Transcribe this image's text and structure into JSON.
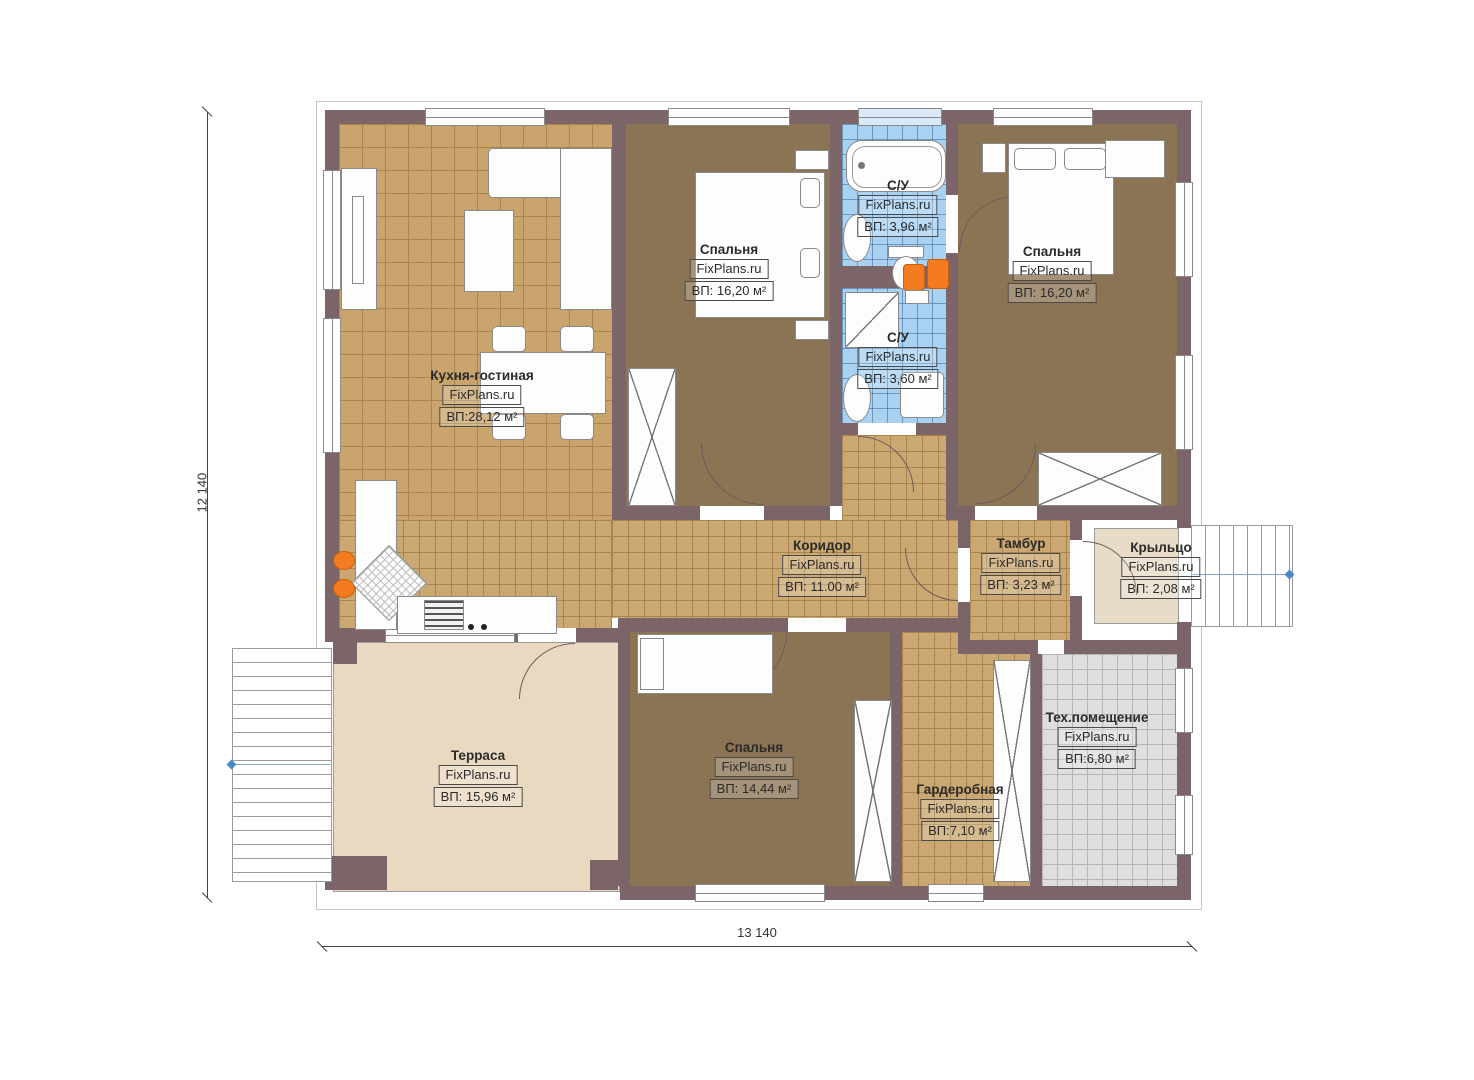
{
  "watermark": {
    "text": "FixPlans.ru"
  },
  "dimensions": {
    "height_label": "12 140",
    "width_label": "13 140"
  },
  "rooms": [
    {
      "key": "kitchen-living",
      "name": "Кухня-гостиная",
      "area": "ВП:28,12 м²"
    },
    {
      "key": "bedroom-top",
      "name": "Спальня",
      "area": "ВП: 16,20 м²"
    },
    {
      "key": "bathroom-top",
      "name": "С/У",
      "area": "ВП: 3,96 м²"
    },
    {
      "key": "bedroom-right",
      "name": "Спальня",
      "area": "ВП: 16,20 м²"
    },
    {
      "key": "bathroom-bottom",
      "name": "С/У",
      "area": "ВП: 3,60 м²"
    },
    {
      "key": "corridor",
      "name": "Коридор",
      "area": "ВП: 11.00 м²"
    },
    {
      "key": "vestibule",
      "name": "Тамбур",
      "area": "ВП: 3,23 м²"
    },
    {
      "key": "porch",
      "name": "Крыльцо",
      "area": "ВП: 2,08 м²"
    },
    {
      "key": "terrace",
      "name": "Терраса",
      "area": "ВП: 15,96 м²"
    },
    {
      "key": "bedroom-bottom",
      "name": "Спальня",
      "area": "ВП: 14,44 м²"
    },
    {
      "key": "wardrobe",
      "name": "Гардеробная",
      "area": "ВП:7,10 м²"
    },
    {
      "key": "tech-room",
      "name": "Тех.помещение",
      "area": "ВП:6,80 м²"
    }
  ],
  "colors": {
    "wall": "#7c6568",
    "bedroom_floor": "#8b7454",
    "tile_floor": "#c9a46c",
    "bath_floor": "#a9d2f2",
    "terrace_floor": "#ead9c1",
    "tech_floor": "#dedede",
    "accent_orange": "#f47b20",
    "dimension_blue": "#4a86c8"
  }
}
